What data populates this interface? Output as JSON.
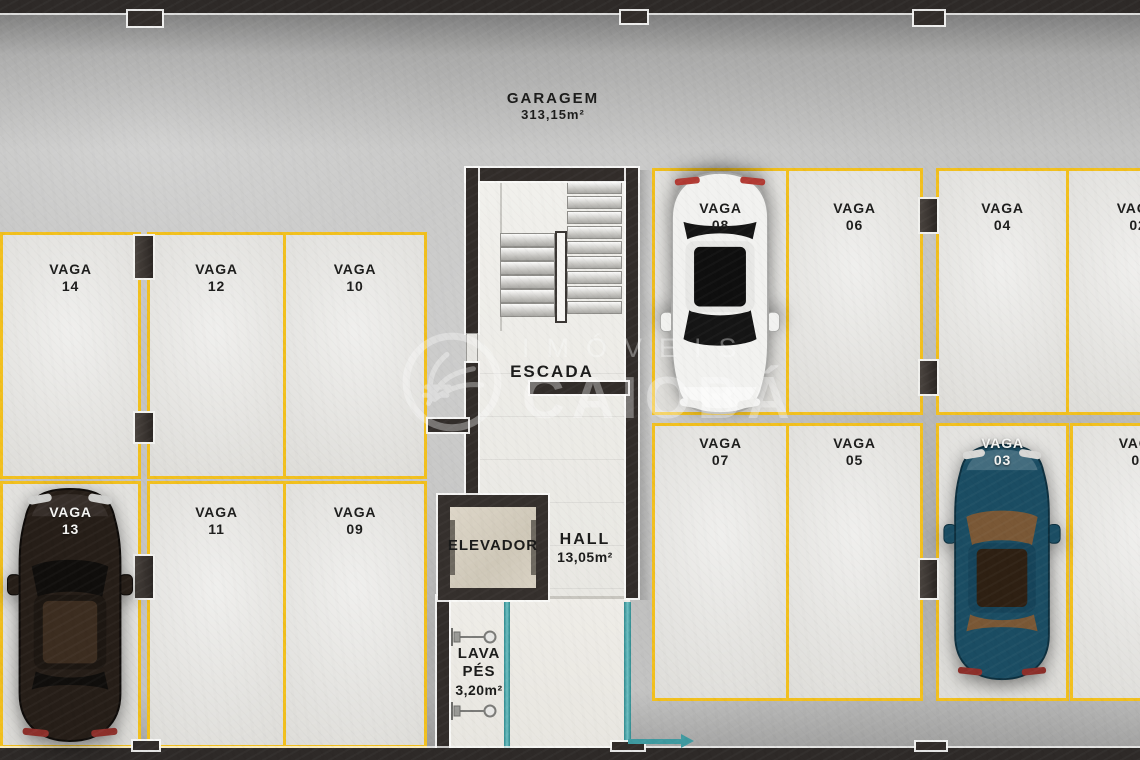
{
  "plan": {
    "title": {
      "name": "GARAGEM",
      "area": "313,15m²"
    },
    "rooms": {
      "stairs": {
        "label": "ESCADA"
      },
      "elevator": {
        "label": "ELEVADOR"
      },
      "hall": {
        "label": "HALL",
        "area": "13,05m²"
      },
      "footwash": {
        "line1": "LAVA",
        "line2": "PÉS",
        "area": "3,20m²"
      }
    },
    "spots": [
      {
        "label": "VAGA",
        "number": "14"
      },
      {
        "label": "VAGA",
        "number": "12"
      },
      {
        "label": "VAGA",
        "number": "10"
      },
      {
        "label": "VAGA",
        "number": "13"
      },
      {
        "label": "VAGA",
        "number": "11"
      },
      {
        "label": "VAGA",
        "number": "09"
      },
      {
        "label": "VAGA",
        "number": "08"
      },
      {
        "label": "VAGA",
        "number": "06"
      },
      {
        "label": "VAGA",
        "number": "04"
      },
      {
        "label": "VAGA",
        "number": "02"
      },
      {
        "label": "VAGA",
        "number": "07"
      },
      {
        "label": "VAGA",
        "number": "05"
      },
      {
        "label": "VAGA",
        "number": "03"
      },
      {
        "label": "VAGA",
        "number": "01"
      }
    ],
    "cars": [
      {
        "spot": "13",
        "color": "#261e18",
        "description": "dark sedan parked"
      },
      {
        "spot": "08",
        "color": "#f2f2f0",
        "description": "white sedan parked"
      },
      {
        "spot": "03",
        "color": "#1b4d63",
        "description": "blue car parked"
      }
    ],
    "watermark": {
      "line1": "IMÓVEIS",
      "line2": "CAIOBÁ"
    },
    "colors": {
      "parking_line": "#f2c01e",
      "wall": "#322d2a",
      "accent_teal": "#4ba4a8",
      "floor_concrete": "#c4c4c3",
      "stall_floor": "#e2e1dd"
    }
  }
}
